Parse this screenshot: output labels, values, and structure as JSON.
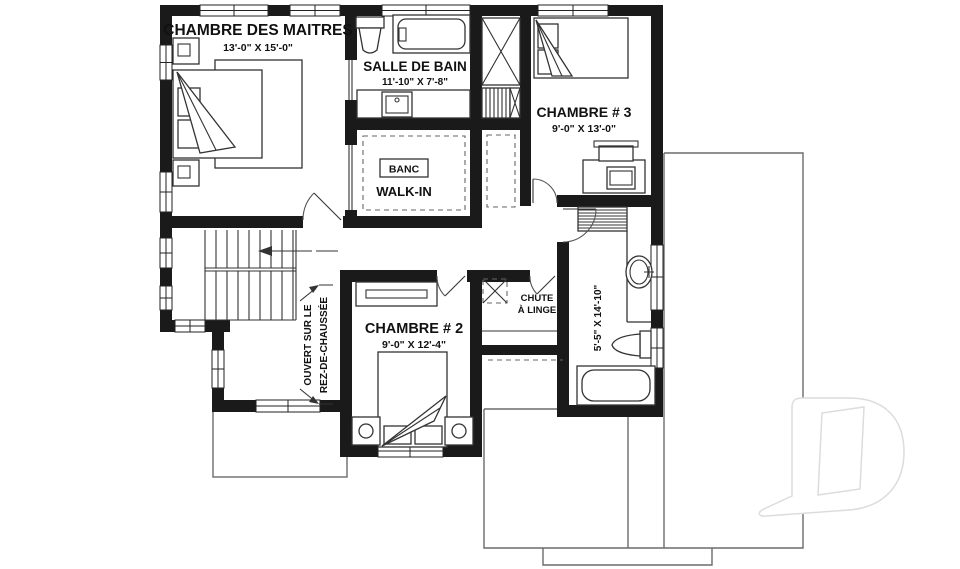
{
  "rooms": {
    "master": {
      "name": "CHAMBRE DES MAITRES",
      "dims": "13'-0\" X 15'-0\""
    },
    "bathroom": {
      "name": "SALLE DE BAIN",
      "dims": "11'-10\" X 7'-8\""
    },
    "walkin": {
      "name": "WALK-IN",
      "bench": "BANC"
    },
    "bedroom3": {
      "name": "CHAMBRE # 3",
      "dims": "9'-0\" X 13'-0\""
    },
    "bedroom2": {
      "name": "CHAMBRE # 2",
      "dims": "9'-0\" X 12'-4\""
    },
    "bathroom2": {
      "dims": "5'-5\" X 14'-10\""
    },
    "laundry_chute": {
      "name_line1": "CHUTE",
      "name_line2": "À LINGE"
    },
    "open_to_below": {
      "line1": "OUVERT SUR LE",
      "line2": "REZ-DE-CHAUSSÉE"
    }
  },
  "watermark": {
    "letter": "D"
  },
  "colors": {
    "background": "#ffffff",
    "wall": "#1a1a1a",
    "line": "#333333",
    "roof_line": "#6b6b6b",
    "dash": "#666666",
    "watermark_stroke": "#dcdcdc"
  }
}
